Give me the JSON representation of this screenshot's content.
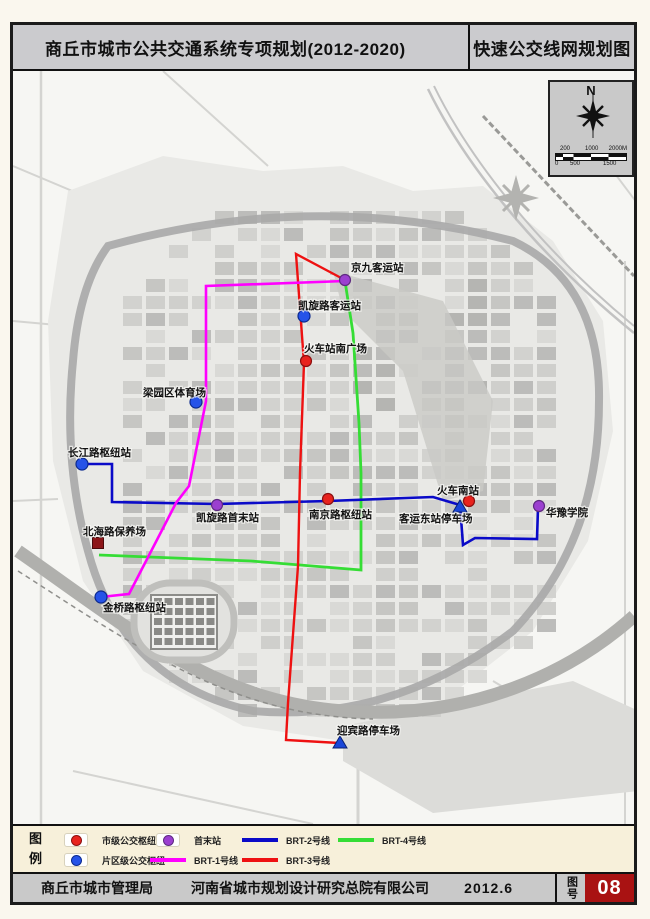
{
  "header": {
    "title_left": "商丘市城市公共交通系统专项规划(2012-2020)",
    "title_right": "快速公交线网规划图"
  },
  "compass": {
    "north_label": "N"
  },
  "scale_bar": {
    "top_labels": [
      "200",
      "1000",
      "2000M"
    ],
    "bottom_labels": [
      "0",
      "500",
      "1500"
    ]
  },
  "map": {
    "lines": [
      {
        "id": "brt-4",
        "name": "BRT-4号线",
        "color": "#35dd35",
        "width": 2.8,
        "points": [
          [
            332,
            210
          ],
          [
            340,
            262
          ],
          [
            346,
            352
          ],
          [
            348,
            402
          ],
          [
            348,
            499
          ],
          [
            238,
            490
          ],
          [
            86,
            484
          ]
        ]
      },
      {
        "id": "brt-2",
        "name": "BRT-2号线",
        "color": "#0a0ac8",
        "width": 2.6,
        "points": [
          [
            69,
            393
          ],
          [
            99,
            393
          ],
          [
            99,
            431
          ],
          [
            204,
            433
          ],
          [
            315,
            430
          ],
          [
            420,
            426
          ],
          [
            447,
            434
          ],
          [
            450,
            474
          ],
          [
            462,
            467
          ],
          [
            524,
            468
          ],
          [
            525,
            437
          ]
        ]
      },
      {
        "id": "brt-3",
        "name": "BRT-3号线",
        "color": "#ee1111",
        "width": 2.4,
        "points": [
          [
            332,
            209
          ],
          [
            283,
            183
          ],
          [
            291,
            292
          ],
          [
            287,
            402
          ],
          [
            285,
            495
          ],
          [
            275,
            632
          ],
          [
            273,
            669
          ],
          [
            326,
            672
          ]
        ]
      },
      {
        "id": "brt-1",
        "name": "BRT-1号线",
        "color": "#ff00ff",
        "width": 2.6,
        "points": [
          [
            332,
            210
          ],
          [
            193,
            215
          ],
          [
            193,
            330
          ],
          [
            176,
            415
          ],
          [
            163,
            432
          ],
          [
            116,
            523
          ],
          [
            88,
            526
          ]
        ]
      }
    ],
    "stations": [
      {
        "id": "jingjiu-coach-station",
        "name": "京九客运站",
        "type": "terminus",
        "x": 332,
        "y": 209,
        "lx": 338,
        "ly": 200
      },
      {
        "id": "kaixuan-road-coach-station",
        "name": "凯旋路客运站",
        "type": "district-hub",
        "x": 291,
        "y": 245,
        "lx": 285,
        "ly": 238
      },
      {
        "id": "railway-station-south-square",
        "name": "火车站南广场",
        "type": "city-hub",
        "x": 293,
        "y": 290,
        "lx": 291,
        "ly": 281
      },
      {
        "id": "liangyuan-district-stadium",
        "name": "梁园区体育场",
        "type": "district-hub",
        "x": 183,
        "y": 331,
        "lx": 130,
        "ly": 325
      },
      {
        "id": "changjiang-road-hub",
        "name": "长江路枢纽站",
        "type": "district-hub",
        "x": 69,
        "y": 393,
        "lx": 55,
        "ly": 385
      },
      {
        "id": "kaixuan-road-terminus",
        "name": "凯旋路首末站",
        "type": "terminus",
        "x": 204,
        "y": 434,
        "lx": 183,
        "ly": 450
      },
      {
        "id": "nanjing-road-hub",
        "name": "南京路枢纽站",
        "type": "city-hub",
        "x": 315,
        "y": 428,
        "lx": 296,
        "ly": 447
      },
      {
        "id": "south-railway-station",
        "name": "火车南站",
        "type": "city-hub",
        "x": 456,
        "y": 430,
        "lx": 424,
        "ly": 423
      },
      {
        "id": "east-coach-station-parking",
        "name": "客运东站停车场",
        "type": "parking",
        "x": 447,
        "y": 436,
        "lx": 386,
        "ly": 451
      },
      {
        "id": "huayu-college",
        "name": "华豫学院",
        "type": "terminus",
        "x": 526,
        "y": 435,
        "lx": 533,
        "ly": 445
      },
      {
        "id": "beihai-road-depot",
        "name": "北海路保养场",
        "type": "depot",
        "x": 85,
        "y": 472,
        "lx": 70,
        "ly": 464
      },
      {
        "id": "jinqiao-road-hub",
        "name": "金桥路枢纽站",
        "type": "district-hub",
        "x": 88,
        "y": 526,
        "lx": 90,
        "ly": 540
      },
      {
        "id": "yingbin-road-parking",
        "name": "迎宾路停车场",
        "type": "parking",
        "x": 327,
        "y": 672,
        "lx": 324,
        "ly": 663
      }
    ],
    "marker_colors": {
      "city-hub": {
        "fill": "#e8231e",
        "ring": "#8b1010"
      },
      "district-hub": {
        "fill": "#2653e8",
        "ring": "#0c2a8e"
      },
      "terminus": {
        "fill": "#9b3fd0",
        "ring": "#5e2a80"
      },
      "parking": {
        "fill": "#1a46d8",
        "ring": "#0a2070"
      },
      "depot": {
        "fill": "#8c1518",
        "ring": "#4a0a0c"
      }
    }
  },
  "legend": {
    "title": "图例",
    "rows": [
      [
        {
          "marker": "dot",
          "color": "#e8231e",
          "ring": "#8b1010",
          "label": "市级公交枢纽"
        },
        {
          "marker": "dot",
          "color": "#9b3fd0",
          "ring": "#5e2a80",
          "label": "首末站"
        },
        {
          "marker": "line",
          "color": "#0a0ac8",
          "label": "BRT-2号线"
        },
        {
          "marker": "line",
          "color": "#35dd35",
          "label": "BRT-4号线"
        }
      ],
      [
        {
          "marker": "dot",
          "color": "#2653e8",
          "ring": "#0c2a8e",
          "label": "片区级公交枢纽"
        },
        {
          "marker": "line",
          "color": "#ff00ff",
          "label": "BRT-1号线"
        },
        {
          "marker": "line",
          "color": "#ee1111",
          "label": "BRT-3号线"
        }
      ]
    ]
  },
  "footer": {
    "agency": "商丘市城市管理局",
    "company": "河南省城市规划设计研究总院有限公司",
    "date": "2012.6",
    "sheet_label": "图号",
    "sheet_number": "08",
    "sheet_number_bg": "#a91212"
  }
}
